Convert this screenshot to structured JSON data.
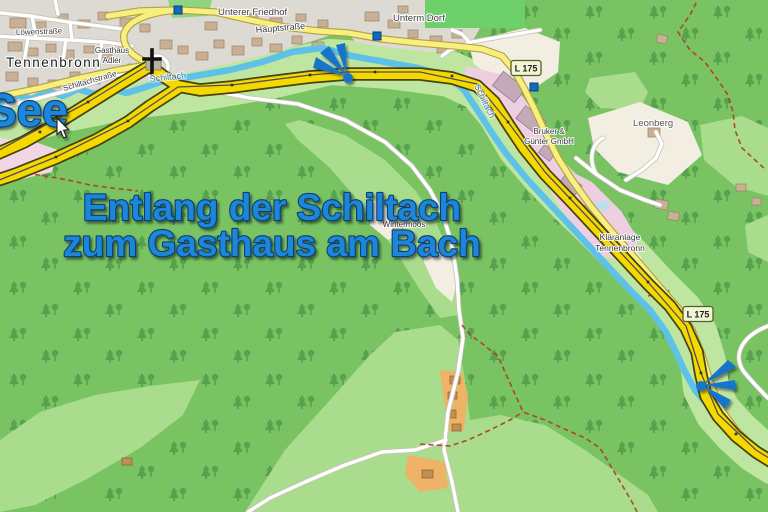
{
  "overlay": {
    "see": "See",
    "caption_line1": "Entlang der Schiltach",
    "caption_line2": "zum Gasthaus am Bach"
  },
  "labels": {
    "town": "Tennenbronn",
    "streets": {
      "loewenstrasse": "Löwenstraße",
      "hauptstrasse": "Hauptstraße",
      "schiltachstrasse": "Schiltachstraße"
    },
    "places": {
      "unterer_friedhof": "Unterer Friedhof",
      "unterm_dorf": "Unterm Dorf",
      "leonberg": "Leonberg",
      "wintermoos": "Wintermoos"
    },
    "pois": {
      "gasthaus_line1": "Gasthaus",
      "gasthaus_line2": "Adler",
      "bruker_line1": "Bruker &",
      "bruker_line2": "Günter GmbH",
      "klaeranlage_line1": "Kläranlage",
      "klaeranlage_line2": "Tennenbronn"
    },
    "river": "Schiltach",
    "road_badge": "L 175"
  },
  "colors": {
    "forest_green": "#79c363",
    "clearing_green": "#a9dc8d",
    "route_yellow": "#f5d800",
    "river_blue": "#5ec2e8",
    "overlay_blue": "#1d86d8",
    "marker_blue": "#1575ca",
    "road_yellow": "#f8f07e",
    "town_gray": "#dcdad2",
    "residential_pink": "#f2d6e6"
  }
}
